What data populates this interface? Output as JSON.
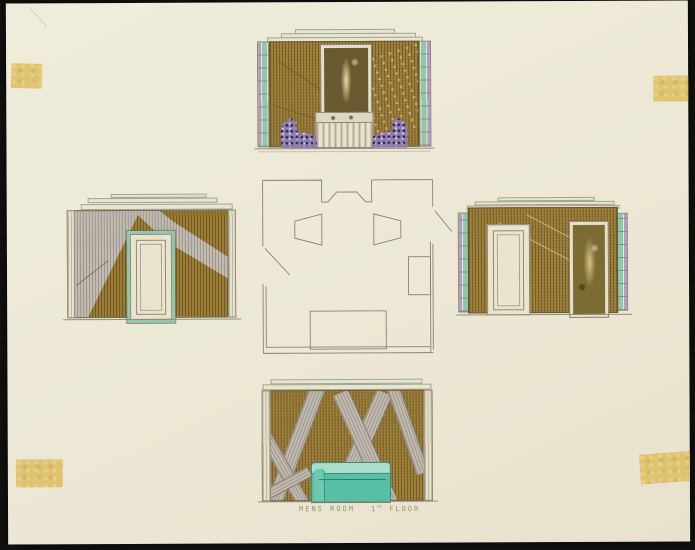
{
  "caption": {
    "room": "MENS ROOM",
    "floor_number": "1",
    "floor_ordinal": "ST",
    "floor_word": "FLOOR"
  },
  "colors": {
    "backdrop": "#121110",
    "paper": "#ece8d5",
    "tape": "#dfc26a",
    "wall_brown": "#9a7c36",
    "band_gray": "#c1bbb1",
    "pencil": "#878174",
    "trim_teal": "#8fc8b1",
    "trim_lavender": "#b29dc3",
    "sofa_teal": "#57bfa6",
    "mirror_olive": "#7c6b33",
    "door_cream": "#eae4cf",
    "upholstery_purple": "#8f7fae"
  }
}
